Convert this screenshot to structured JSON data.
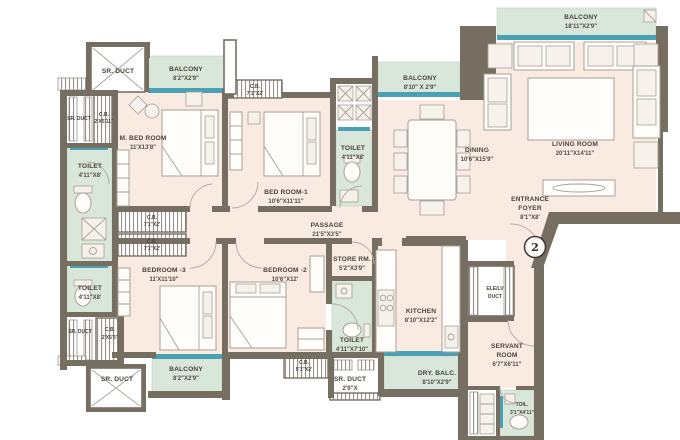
{
  "unit_number": "2",
  "colors": {
    "wall": "#776e62",
    "room_cream": "#f9ebe2",
    "wet_area_mint": "#d8e7da",
    "window_teal": "#49a1b3",
    "label_text": "#4b4238"
  },
  "rooms": {
    "sr_duct_tl": {
      "name": "SR. DUCT"
    },
    "balcony_tl": {
      "name": "BALCONY",
      "dims": "8'2\"X2'9\""
    },
    "sr_duct_left": {
      "name": "SR. DUCT"
    },
    "cb_left": {
      "name": "C.B.",
      "dims": "2'X5'11\""
    },
    "m_bedroom": {
      "name": "M. BED ROOM",
      "dims": "11'X13'8\""
    },
    "toilet_mbed": {
      "name": "TOILET",
      "dims": "4'11\"X8'"
    },
    "cb_top": {
      "name": "C.B.",
      "dims": "7'1\"X2'"
    },
    "bedroom1": {
      "name": "BED ROOM-1",
      "dims": "10'6\"X11'11\""
    },
    "toilet_mid": {
      "name": "TOILET",
      "dims": "4'11\"X8'"
    },
    "balcony_tm": {
      "name": "BALCONY",
      "dims": "8'10\" X 2'9\""
    },
    "balcony_tr": {
      "name": "BALCONY",
      "dims": "18'11\"X2'9\""
    },
    "living": {
      "name": "LIVING ROOM",
      "dims": "20'11\"X14'11\""
    },
    "dining": {
      "name": "DINING",
      "dims": "10'6\"X15'9\""
    },
    "entrance_foyer": {
      "line1": "ENTRANCE",
      "line2": "FOYER",
      "dims": "8'1\"X8'"
    },
    "passage": {
      "name": "PASSAGE",
      "dims": "21'5\"X3'5\""
    },
    "cb_mid1": {
      "name": "C.B.",
      "dims": "7'1\"X2'"
    },
    "cb_mid2": {
      "name": "C.B.",
      "dims": "7'1\"X2'"
    },
    "bedroom3": {
      "name": "BEDROOM -3",
      "dims": "11'X11'10\""
    },
    "bedroom2": {
      "name": "BEDROOM -2",
      "dims": "10'6\"X12'"
    },
    "toilet_b3": {
      "name": "TOILET",
      "dims": "4'11\"X8'"
    },
    "sr_duct_l2": {
      "name": "SR. DUCT"
    },
    "cb_l2": {
      "name": "C.B.",
      "dims": "2'X5'3\""
    },
    "sr_duct_bl": {
      "name": "SR. DUCT"
    },
    "balcony_bl": {
      "name": "BALCONY",
      "dims": "8'2\"X2'9\""
    },
    "store": {
      "name": "STORE RM.",
      "dims": "5'2\"X3'9\""
    },
    "toilet_kitchen": {
      "name": "TOILET",
      "dims": "4'11\"X7'10\""
    },
    "kitchen": {
      "name": "KITCHEN",
      "dims": "8'10\"X12'2\""
    },
    "cb_bottom": {
      "name": "C.B.",
      "dims": "5'1\"X2'"
    },
    "sr_duct_bm": {
      "name": "SR. DUCT",
      "dims": "2'9\"X"
    },
    "dry_balcony": {
      "name": "DRY. BALC.",
      "dims": "8'10\"X2'9\""
    },
    "elev_duct": {
      "line1": "ELE/LV",
      "line2": "DUCT"
    },
    "servant": {
      "line1": "SERVANT",
      "line2": "ROOM",
      "dims": "6'7\"X6'11\""
    },
    "toil_servant": {
      "name": "TOIL.",
      "dims": "3'1\"X4'11\""
    }
  }
}
